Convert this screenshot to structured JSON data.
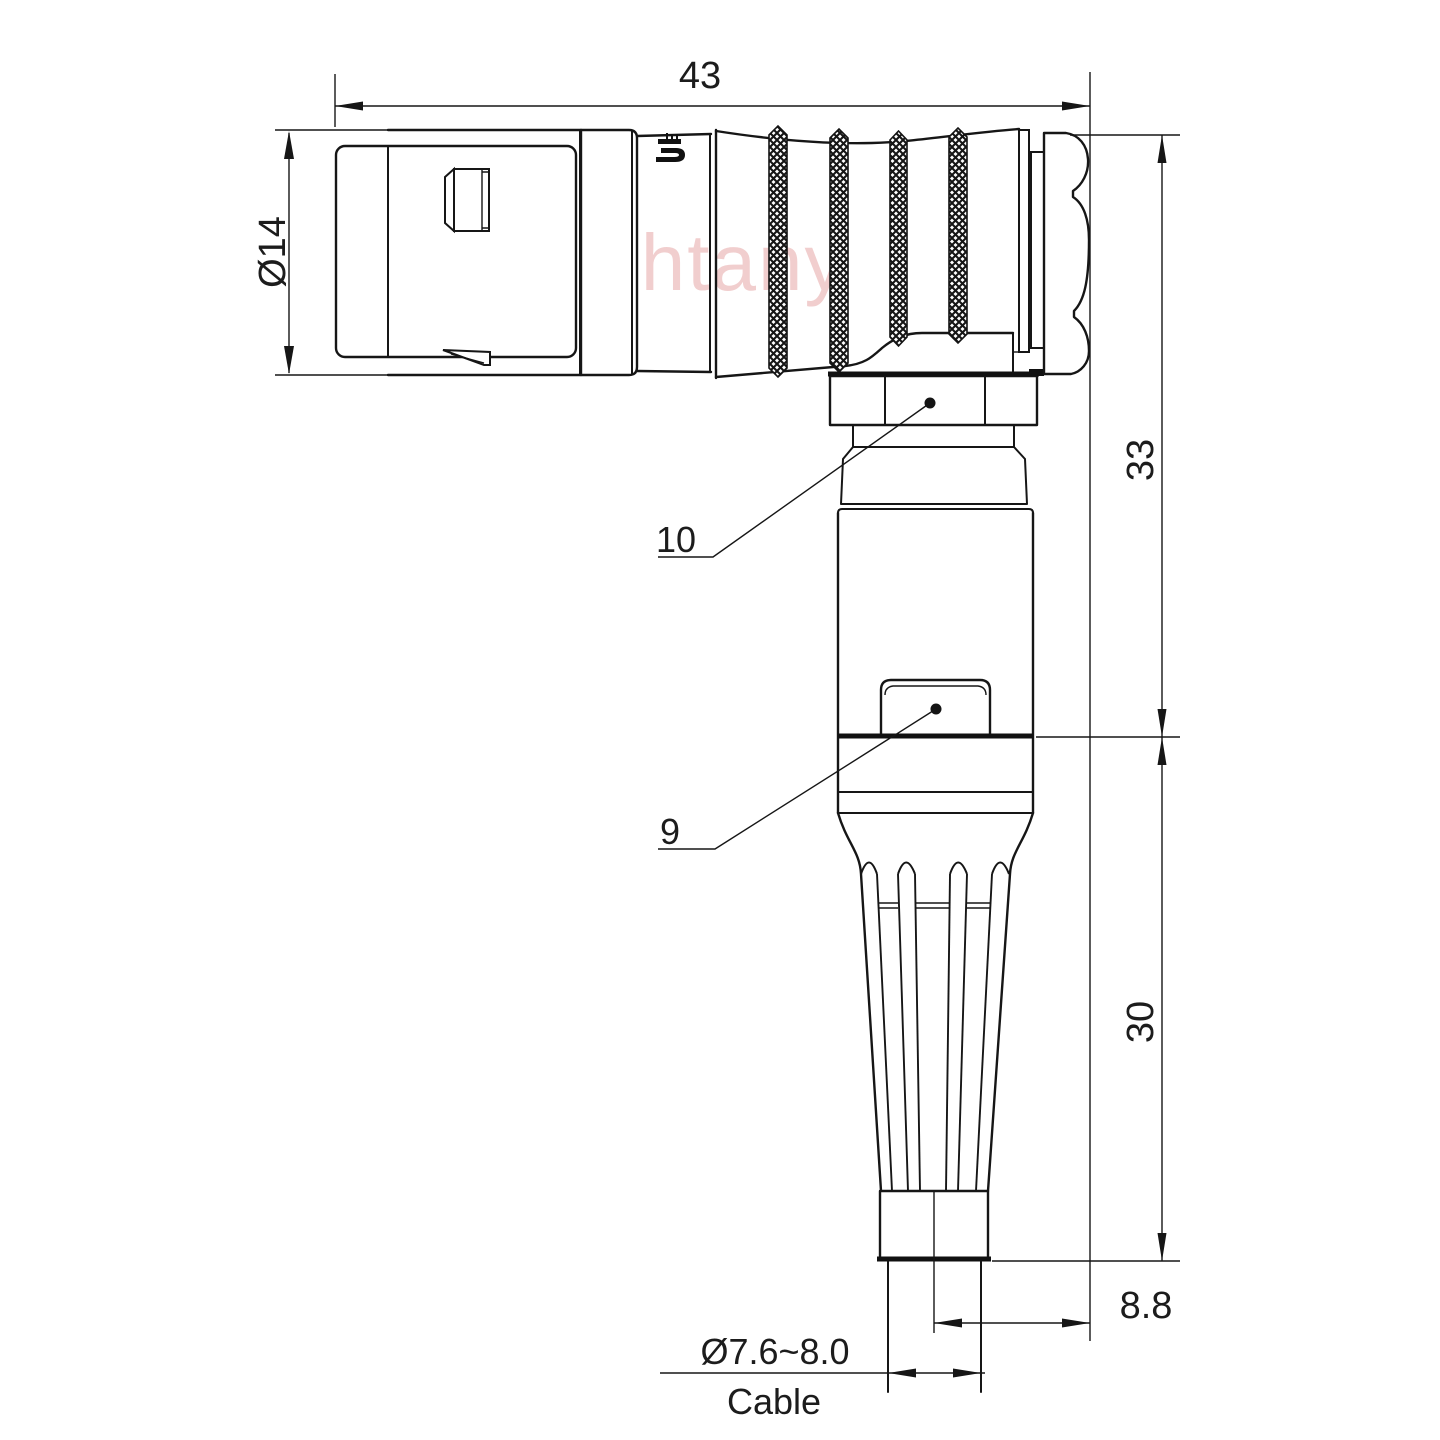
{
  "watermark": {
    "text": "Lightany",
    "color": "#eec3c3"
  },
  "dims": {
    "total_length": "43",
    "front_diameter": "Ø14",
    "upper_height": "33",
    "boot_height": "30",
    "axis_offset": "8.8",
    "cable_diameter": "Ø7.6~8.0",
    "cable_label": "Cable"
  },
  "callouts": {
    "coupling_nut": "10",
    "cable_latch": "9"
  },
  "colors": {
    "line": "#161616",
    "watermark_pink": "#eec3c3"
  }
}
